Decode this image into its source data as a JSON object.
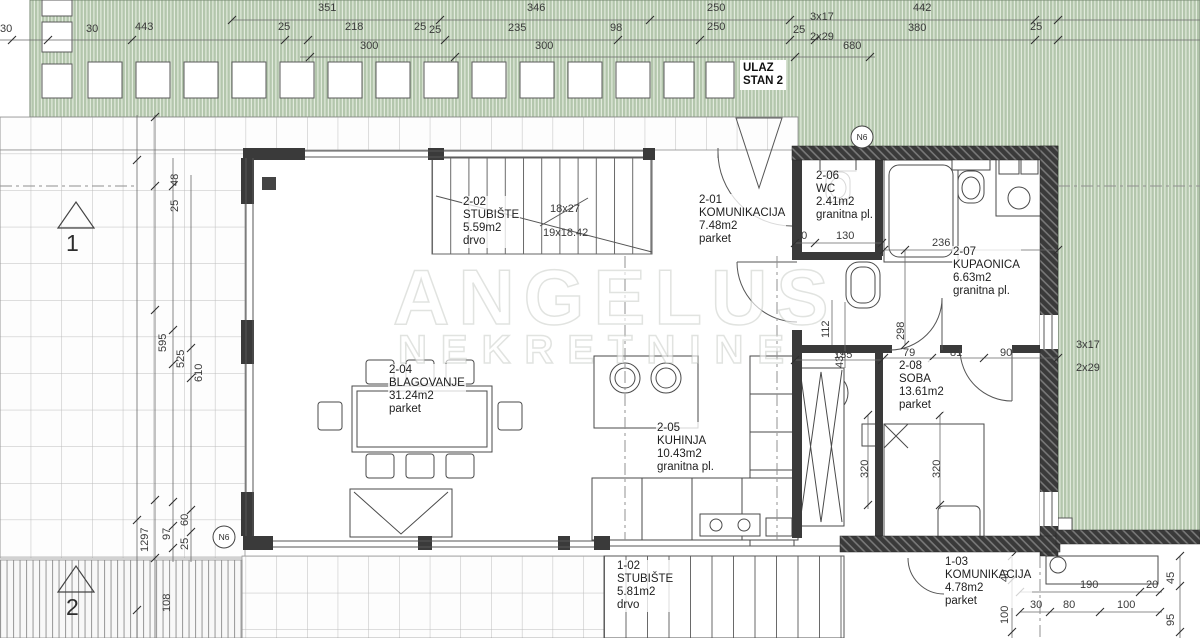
{
  "watermark": {
    "line1": "ANGELUS",
    "line2": "NEKRETNINE"
  },
  "entrance": {
    "line1": "ULAZ",
    "line2": "STAN 2"
  },
  "markers": {
    "section_top": "1",
    "section_bottom": "2",
    "node_top": "N6",
    "node_left": "N6"
  },
  "colors": {
    "terrace_green": "#b3c6ac",
    "wall_dark": "#3a3a3a",
    "line": "#555555"
  },
  "rooms": {
    "stubiste2": {
      "id": "2-02",
      "name": "STUBIŠTE",
      "area": "5.59m2",
      "floor": "drvo"
    },
    "komunikacija2": {
      "id": "2-01",
      "name": "KOMUNIKACIJA",
      "area": "7.48m2",
      "floor": "parket"
    },
    "wc": {
      "id": "2-06",
      "name": "WC",
      "area": "2.41m2",
      "floor": "granitna pl."
    },
    "kupaonica": {
      "id": "2-07",
      "name": "KUPAONICA",
      "area": "6.63m2",
      "floor": "granitna pl."
    },
    "blagovanje": {
      "id": "2-04",
      "name": "BLAGOVANJE",
      "area": "31.24m2",
      "floor": "parket"
    },
    "kuhinja": {
      "id": "2-05",
      "name": "KUHINJA",
      "area": "10.43m2",
      "floor": "granitna pl."
    },
    "soba": {
      "id": "2-08",
      "name": "SOBA",
      "area": "13.61m2",
      "floor": "parket"
    },
    "stubiste1": {
      "id": "1-02",
      "name": "STUBIŠTE",
      "area": "5.81m2",
      "floor": "drvo"
    },
    "komunikacija1": {
      "id": "1-03",
      "name": "KOMUNIKACIJA",
      "area": "4.78m2",
      "floor": "parket"
    }
  },
  "stairs": {
    "note_a": "18x27",
    "note_b": "19x18.42",
    "top_a": "3x17",
    "top_b": "2x29",
    "green_a": "3x17",
    "green_b": "2x29"
  },
  "dims": {
    "t351": "351",
    "t346": "346",
    "t250a": "250",
    "t442": "442",
    "t30a": "30",
    "t30b": "30",
    "t443": "443",
    "t25a": "25",
    "t218": "218",
    "t25b": "25",
    "t25c": "25",
    "t235": "235",
    "t98": "98",
    "t250b": "250",
    "t25d": "25",
    "t380": "380",
    "t25e": "25",
    "t300a": "300",
    "t300b": "300",
    "t680": "680",
    "l48": "48",
    "l25": "25",
    "l595": "595",
    "l525": "525",
    "l610": "610",
    "l1297": "1297",
    "l97": "97",
    "l60": "60",
    "l25b": "25",
    "l108": "108",
    "i20": "20",
    "i130": "130",
    "i236": "236",
    "i298": "298",
    "i112": "112",
    "i432": "432",
    "i135": "135",
    "i79": "79",
    "i81": "81",
    "i90": "90",
    "i320a": "320",
    "i320b": "320",
    "b40": "40",
    "b100a": "100",
    "b190": "190",
    "b20": "20",
    "b30": "30",
    "b80": "80",
    "b100b": "100",
    "b45": "45",
    "b95": "95"
  }
}
